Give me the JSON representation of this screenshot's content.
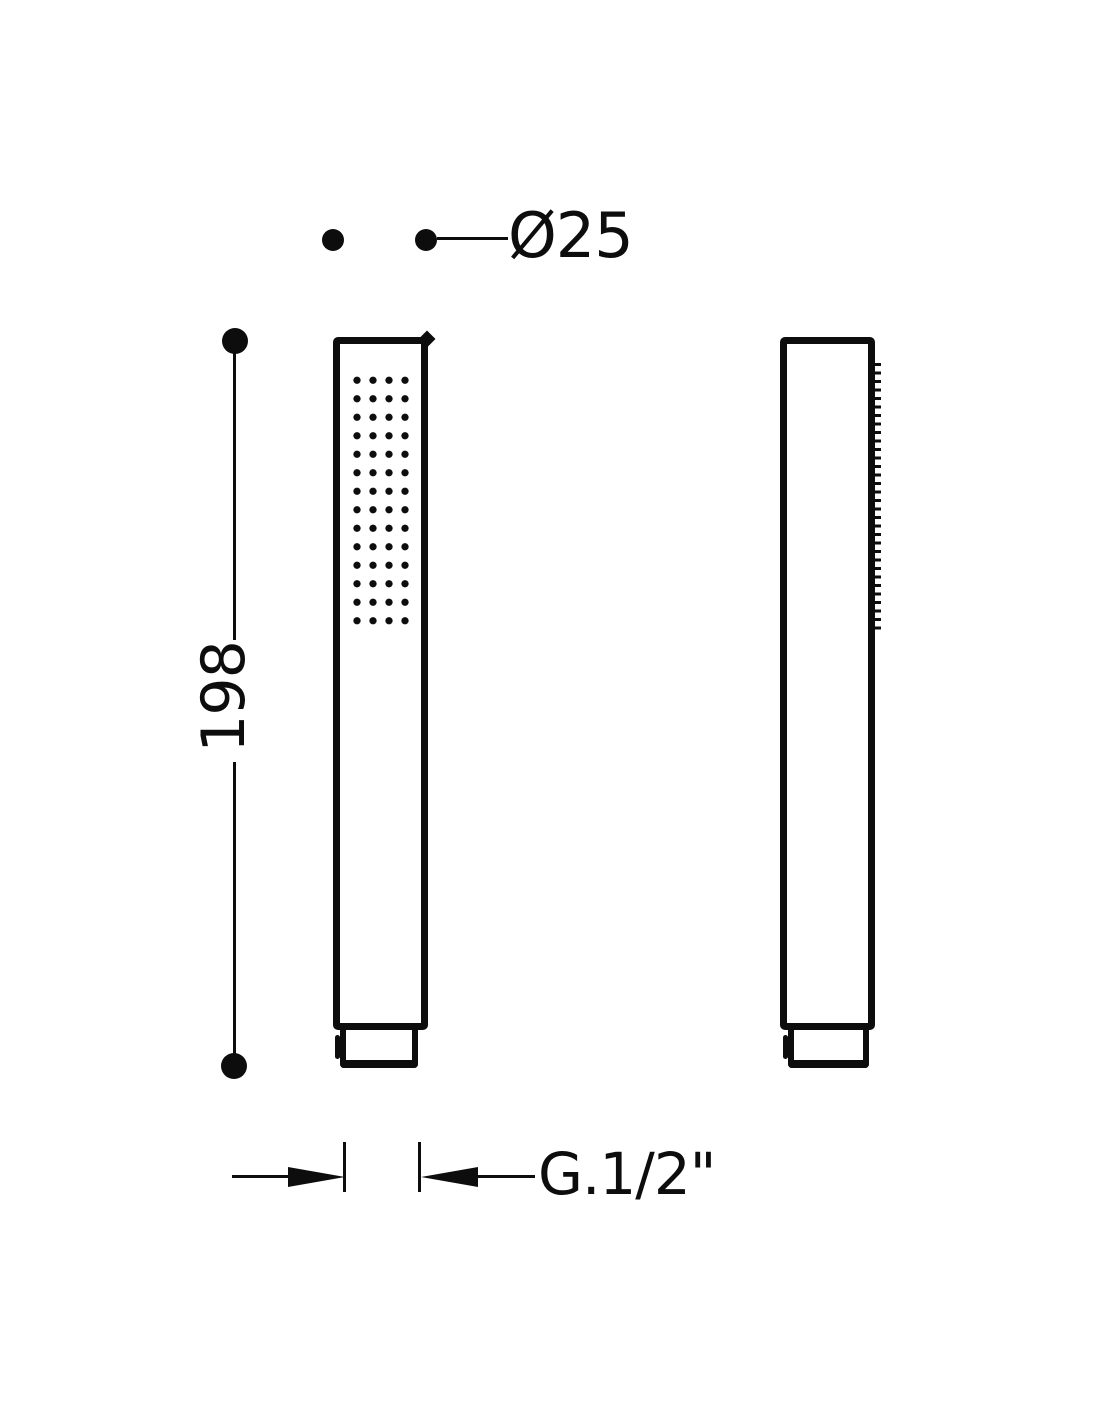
{
  "drawing": {
    "background_color": "#ffffff",
    "ink_color": "#0d0d0d",
    "annotations": {
      "diameter_label": "Ø25",
      "height_label": "198",
      "thread_label": "G.1/2\""
    }
  }
}
